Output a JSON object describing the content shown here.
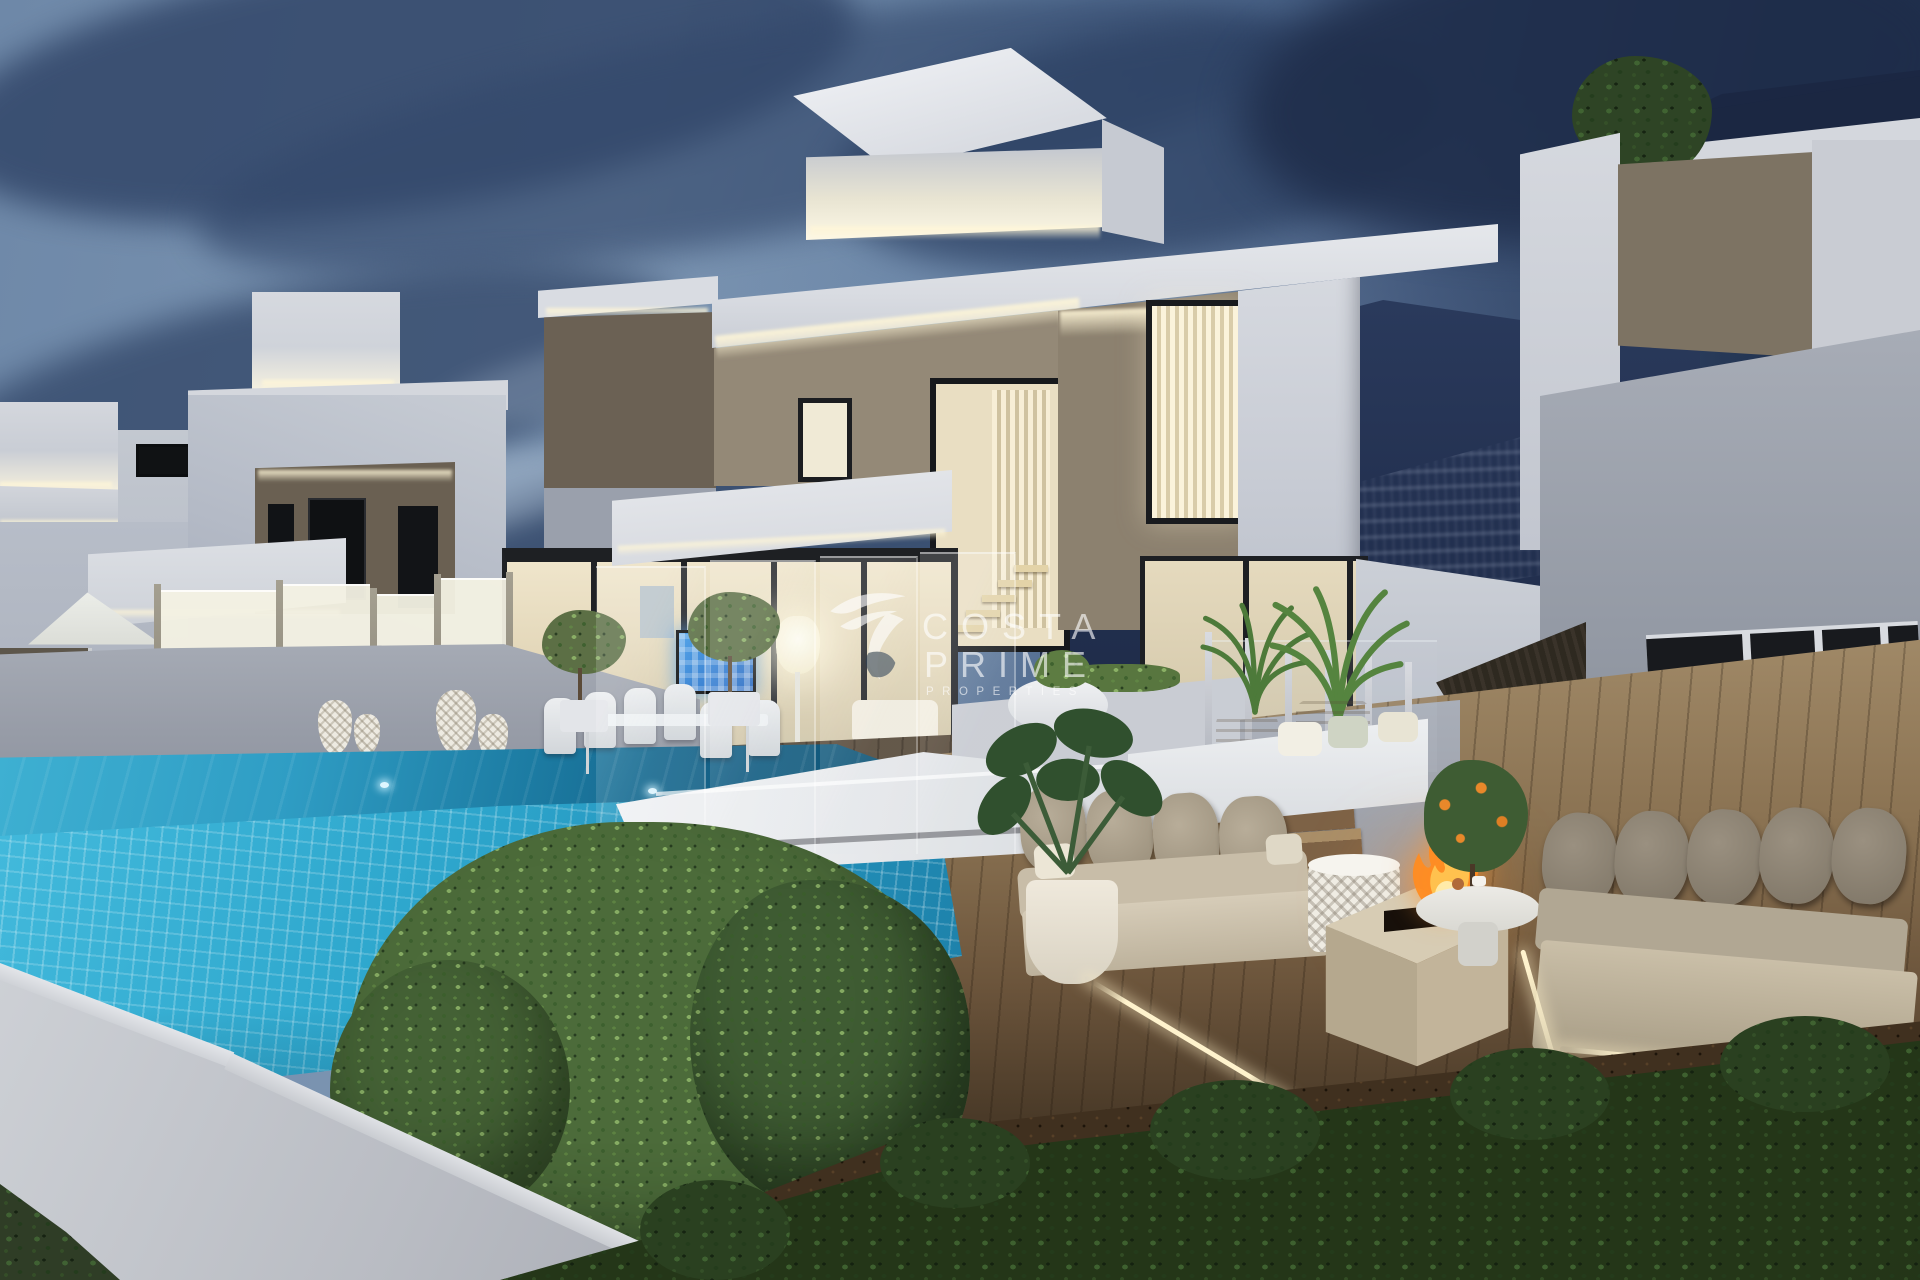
{
  "watermark": {
    "icon": "hummingbird-logo-icon",
    "line1": "COSTA",
    "line2": "PRIME",
    "line3": "PROPERTIES",
    "color": "#ffffff"
  },
  "palette": {
    "sky_light": "#7e96b3",
    "sky_dark": "#1c2a46",
    "cloud_slate": "#2f4266",
    "mountain_navy": "#243252",
    "villa_white": "#d8dbe1",
    "villa_shadow": "#9aa0ac",
    "stone_cladding": "#8d8170",
    "led_warm": "#fff3d2",
    "pool_turquoise": "#2ea7cd",
    "pool_deep": "#10587a",
    "deck_wood": "#8a7252",
    "hedge_green": "#4c6b3a",
    "fire_orange": "#ff8c2a",
    "sofa_taupe": "#aba18d",
    "tv_screen_blue": "#2f7fd0",
    "glass_fence_warm": "#f3f1e3"
  }
}
